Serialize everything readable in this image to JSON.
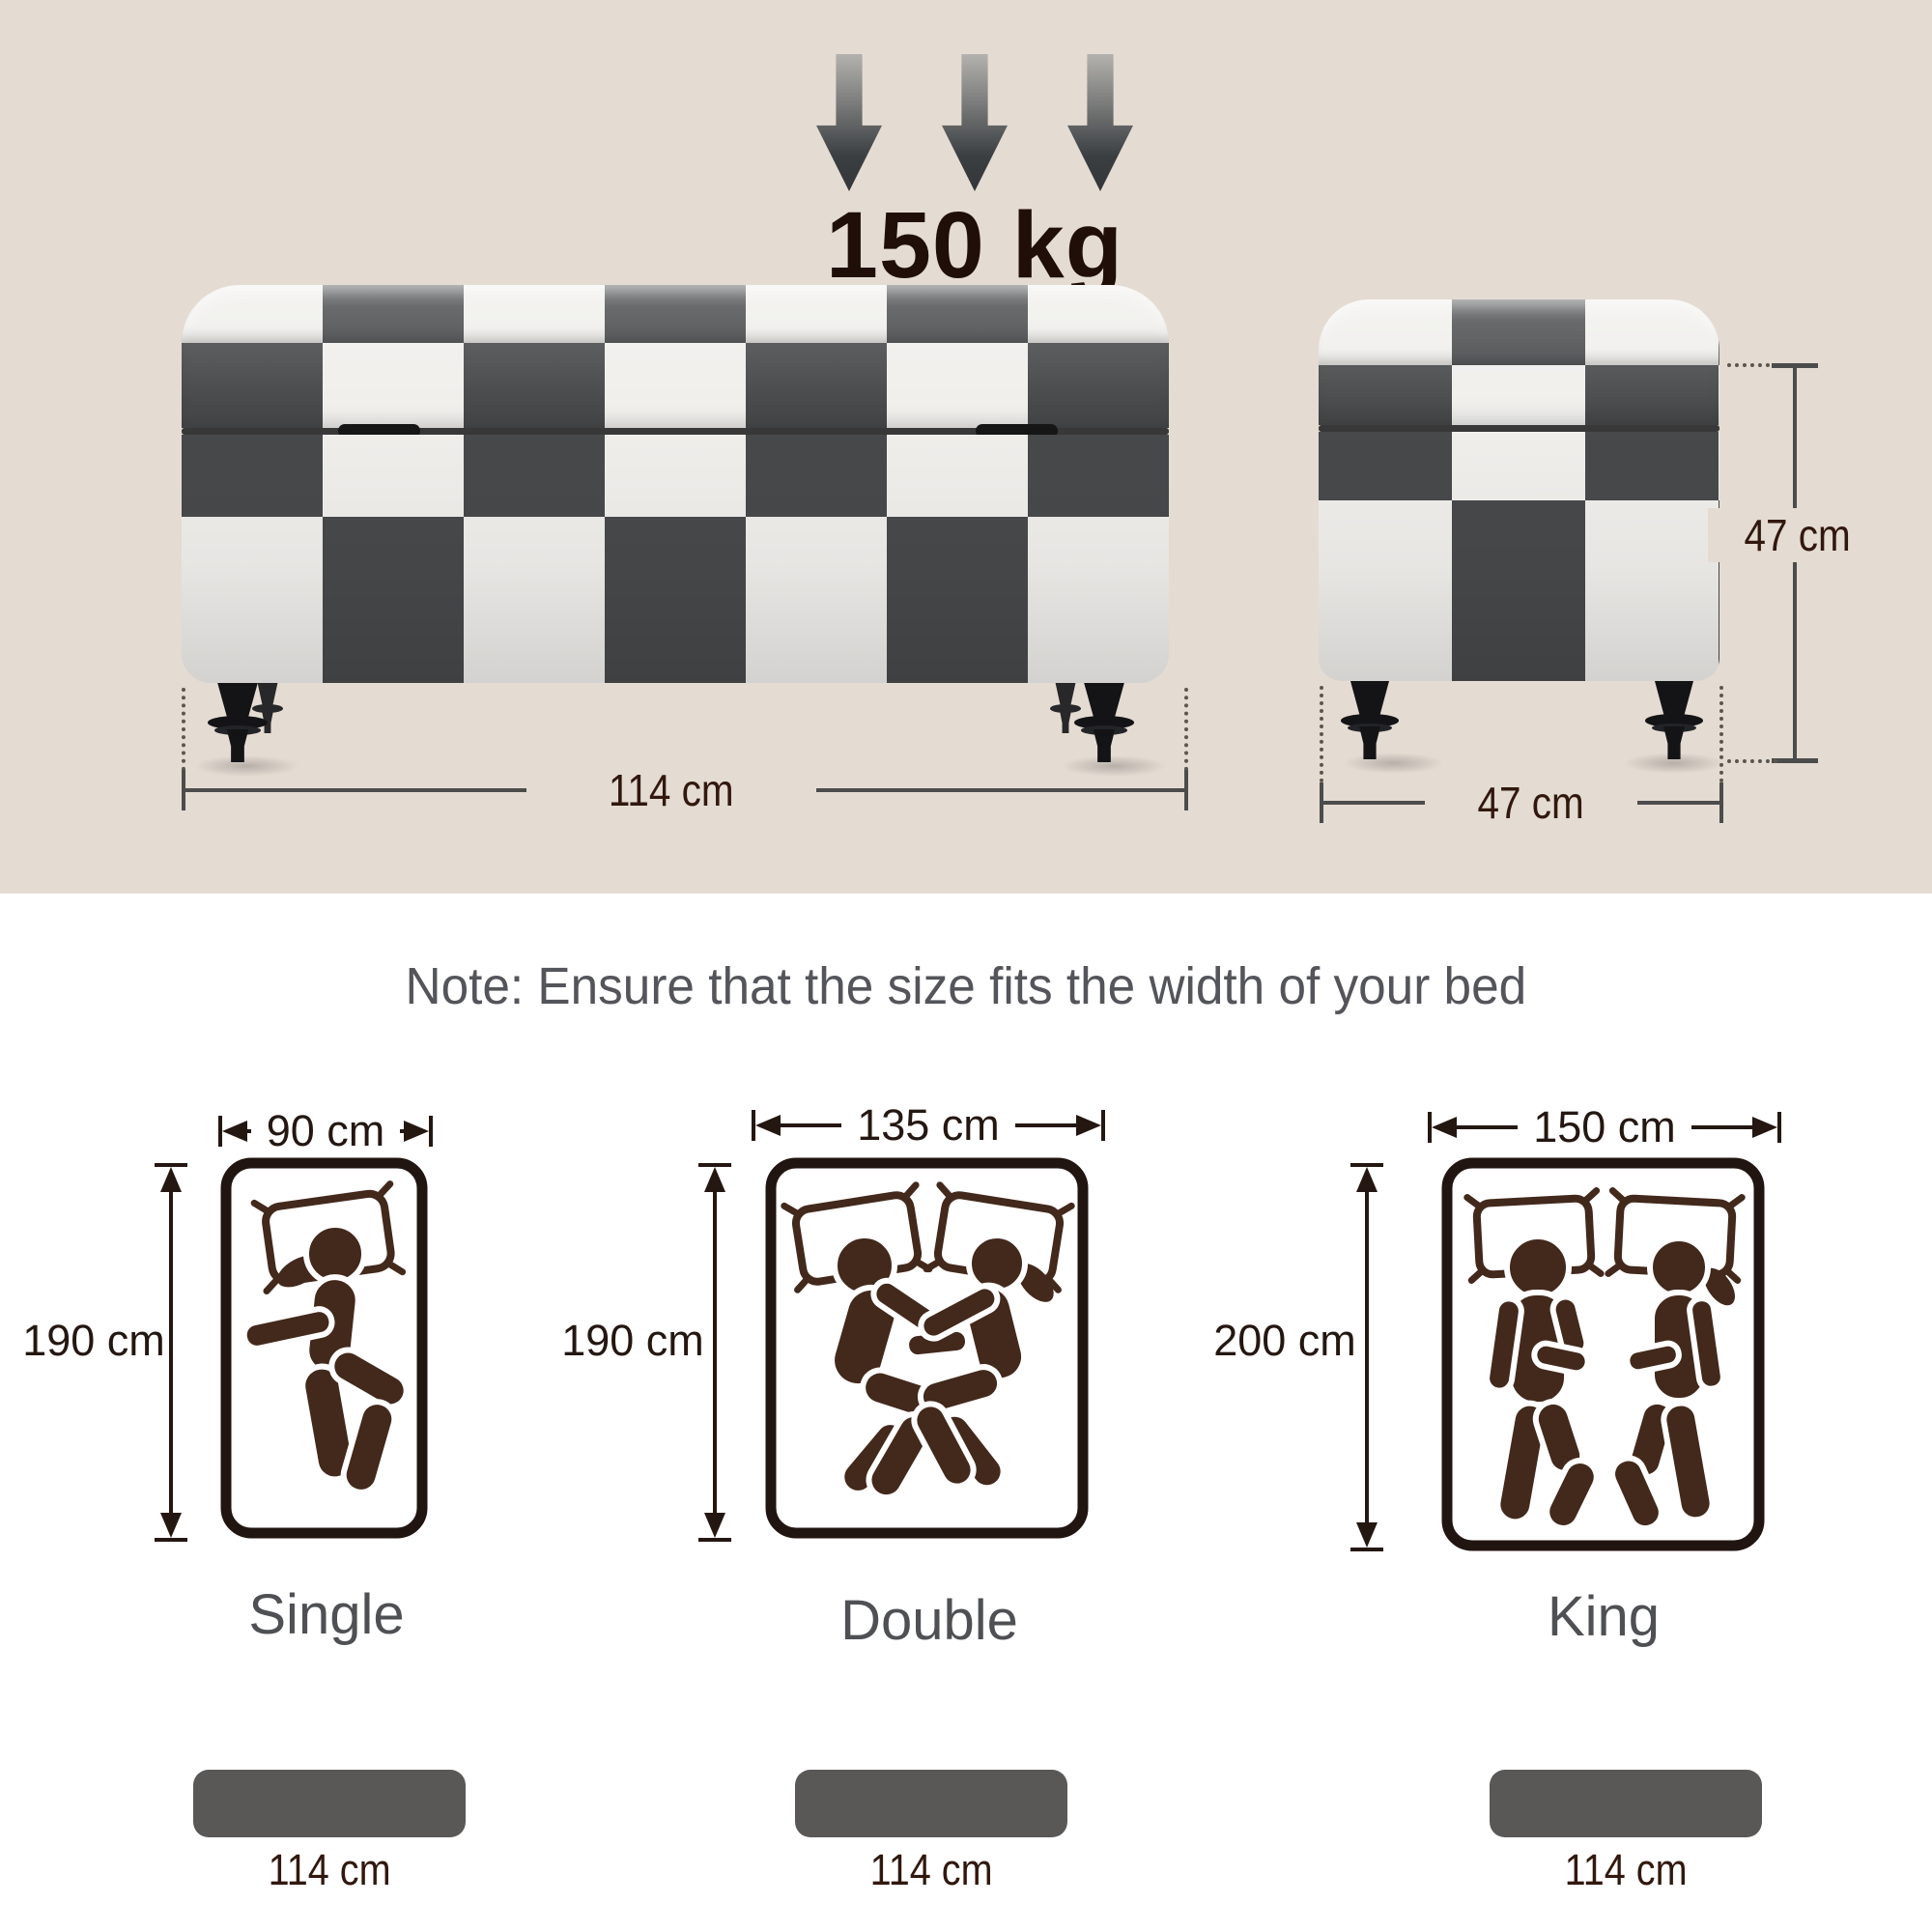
{
  "colors": {
    "beige_bg": "#e4dbd2",
    "checker_dark": "#47494b",
    "checker_white": "#f0efec",
    "leg_black": "#141417",
    "dim_line_gray": "#4c4c4c",
    "dim_text_brown": "#31180e",
    "weight_text": "#1f0f08",
    "note_gray": "#54555a",
    "figure_brown": "#42291c",
    "bed_dim_text": "#241712",
    "bar_gray": "#595857",
    "bed_border": "#201510"
  },
  "weight": {
    "value": "150 kg"
  },
  "ottoman": {
    "front_width": "114 cm",
    "side_height": "47 cm",
    "side_depth": "47 cm"
  },
  "note": {
    "text": "Note: Ensure that the size fits the width of your bed"
  },
  "beds": [
    {
      "name": "Single",
      "width": "90 cm",
      "length": "190 cm",
      "bench_width": "114 cm"
    },
    {
      "name": "Double",
      "width": "135 cm",
      "length": "190 cm",
      "bench_width": "114 cm"
    },
    {
      "name": "King",
      "width": "150 cm",
      "length": "200 cm",
      "bench_width": "114 cm"
    }
  ]
}
